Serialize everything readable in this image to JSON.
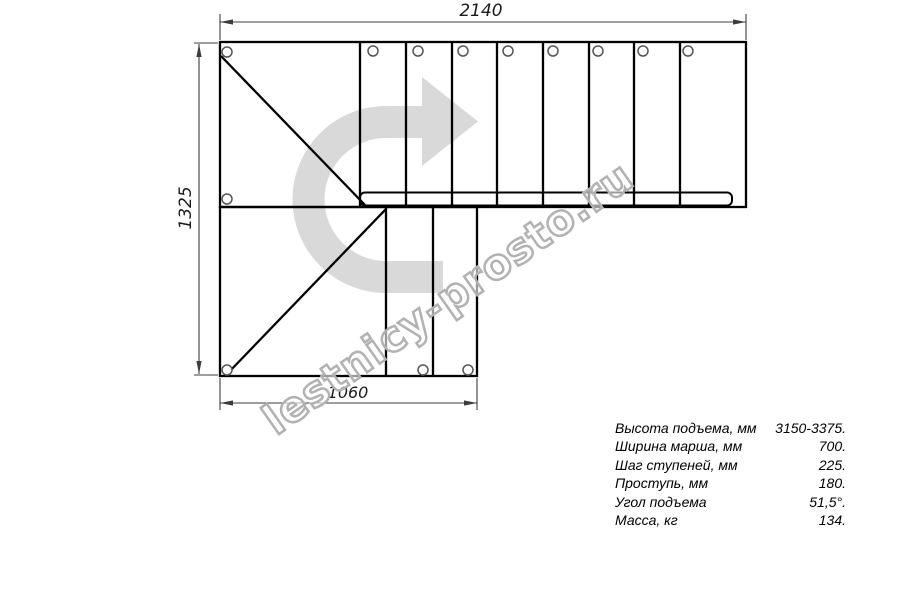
{
  "drawing": {
    "type": "staircase-plan-top-view",
    "dimensions": {
      "top": "2140",
      "left": "1325",
      "bottom": "1060"
    },
    "direction_arrow_icon": "curved-u-arrow-pointing-right",
    "watermark_text": "lestnicy-prosto.ru"
  },
  "specs": {
    "rows": [
      {
        "label": "Высота подъема, мм",
        "value": "3150-3375."
      },
      {
        "label": "Ширина марша, мм",
        "value": "700."
      },
      {
        "label": "Шаг ступеней, мм",
        "value": "225."
      },
      {
        "label": "Проступь, мм",
        "value": "180."
      },
      {
        "label": "Угол подъема",
        "value": "51,5°."
      },
      {
        "label": "Масса, кг",
        "value": "134."
      }
    ]
  },
  "colors": {
    "background": "#ffffff",
    "main_line": "#000000",
    "dimension_line": "#3c3c3c",
    "fastener_circle": "#555555",
    "direction_arrow": "#d9d9d9",
    "watermark_outline": "#b2b2b2"
  }
}
